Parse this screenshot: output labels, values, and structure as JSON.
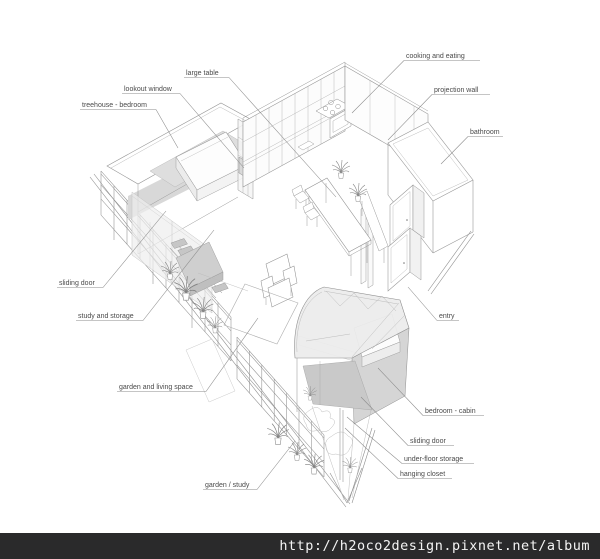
{
  "watermark": {
    "url_text": "http://h2oco2design.pixnet.net/album",
    "bar_color": "#2a2a2b",
    "text_color": "#f4f4f4"
  },
  "drawing": {
    "description": "axonometric cutaway drawing of a narrow wedge-shaped apartment",
    "ink_color": "#9b9b9b",
    "label_color": "#4a4a4a",
    "leader_color": "#8c8c8c",
    "labels": [
      {
        "id": "cooking-and-eating",
        "text": "cooking and eating",
        "tx": 406,
        "ty": 58,
        "ux1": 404,
        "ux2": 480,
        "uy": 60.5,
        "lx1": 404,
        "ly1": 60.5,
        "lx2": 352,
        "ly2": 113
      },
      {
        "id": "large-table",
        "text": "large table",
        "tx": 186,
        "ty": 75,
        "ux1": 184,
        "ux2": 229,
        "uy": 77.5,
        "lx1": 229,
        "ly1": 77.5,
        "lx2": 336,
        "ly2": 197
      },
      {
        "id": "lookout-window",
        "text": "lookout window",
        "tx": 124,
        "ty": 91,
        "ux1": 122,
        "ux2": 180,
        "uy": 93.5,
        "lx1": 180,
        "ly1": 93.5,
        "lx2": 244,
        "ly2": 168
      },
      {
        "id": "treehouse-bedroom",
        "text": "treehouse - bedroom",
        "tx": 82,
        "ty": 107,
        "ux1": 80,
        "ux2": 156,
        "uy": 109.5,
        "lx1": 156,
        "ly1": 109.5,
        "lx2": 178,
        "ly2": 148
      },
      {
        "id": "projection-wall",
        "text": "projection wall",
        "tx": 434,
        "ty": 92,
        "ux1": 432,
        "ux2": 490,
        "uy": 94.5,
        "lx1": 432,
        "ly1": 94.5,
        "lx2": 388,
        "ly2": 140
      },
      {
        "id": "bathroom",
        "text": "bathroom",
        "tx": 470,
        "ty": 134,
        "ux1": 468,
        "ux2": 503,
        "uy": 136.5,
        "lx1": 468,
        "ly1": 136.5,
        "lx2": 441,
        "ly2": 164
      },
      {
        "id": "sliding-door-left",
        "text": "sliding door",
        "tx": 59,
        "ty": 285,
        "ux1": 57,
        "ux2": 103,
        "uy": 287.5,
        "lx1": 103,
        "ly1": 287.5,
        "lx2": 166,
        "ly2": 211
      },
      {
        "id": "study-and-storage",
        "text": "study and storage",
        "tx": 78,
        "ty": 318,
        "ux1": 76,
        "ux2": 143,
        "uy": 320.5,
        "lx1": 143,
        "ly1": 320.5,
        "lx2": 214,
        "ly2": 230
      },
      {
        "id": "garden-and-living-space",
        "text": "garden and living space",
        "tx": 119,
        "ty": 389,
        "ux1": 117,
        "ux2": 206,
        "uy": 391.5,
        "lx1": 206,
        "ly1": 391.5,
        "lx2": 258,
        "ly2": 318
      },
      {
        "id": "entry",
        "text": "entry",
        "tx": 439,
        "ty": 318,
        "ux1": 437,
        "ux2": 459,
        "uy": 320.5,
        "lx1": 437,
        "ly1": 320.5,
        "lx2": 408,
        "ly2": 287
      },
      {
        "id": "garden-study",
        "text": "garden / study",
        "tx": 205,
        "ty": 487,
        "ux1": 203,
        "ux2": 257,
        "uy": 489.5,
        "lx1": 257,
        "ly1": 489.5,
        "lx2": 295,
        "ly2": 441
      },
      {
        "id": "bedroom-cabin",
        "text": "bedroom - cabin",
        "tx": 425,
        "ty": 413,
        "ux1": 423,
        "ux2": 484,
        "uy": 415.5,
        "lx1": 423,
        "ly1": 415.5,
        "lx2": 378,
        "ly2": 368
      },
      {
        "id": "sliding-door-right",
        "text": "sliding door",
        "tx": 410,
        "ty": 443,
        "ux1": 408,
        "ux2": 454,
        "uy": 445.5,
        "lx1": 408,
        "ly1": 445.5,
        "lx2": 361,
        "ly2": 397
      },
      {
        "id": "under-floor-storage",
        "text": "under-floor storage",
        "tx": 404,
        "ty": 461,
        "ux1": 402,
        "ux2": 474,
        "uy": 463.5,
        "lx1": 402,
        "ly1": 463.5,
        "lx2": 347,
        "ly2": 417
      },
      {
        "id": "hanging-closet",
        "text": "hanging closet",
        "tx": 400,
        "ty": 476,
        "ux1": 398,
        "ux2": 452,
        "uy": 478.5,
        "lx1": 398,
        "ly1": 478.5,
        "lx2": 345,
        "ly2": 428
      }
    ]
  }
}
